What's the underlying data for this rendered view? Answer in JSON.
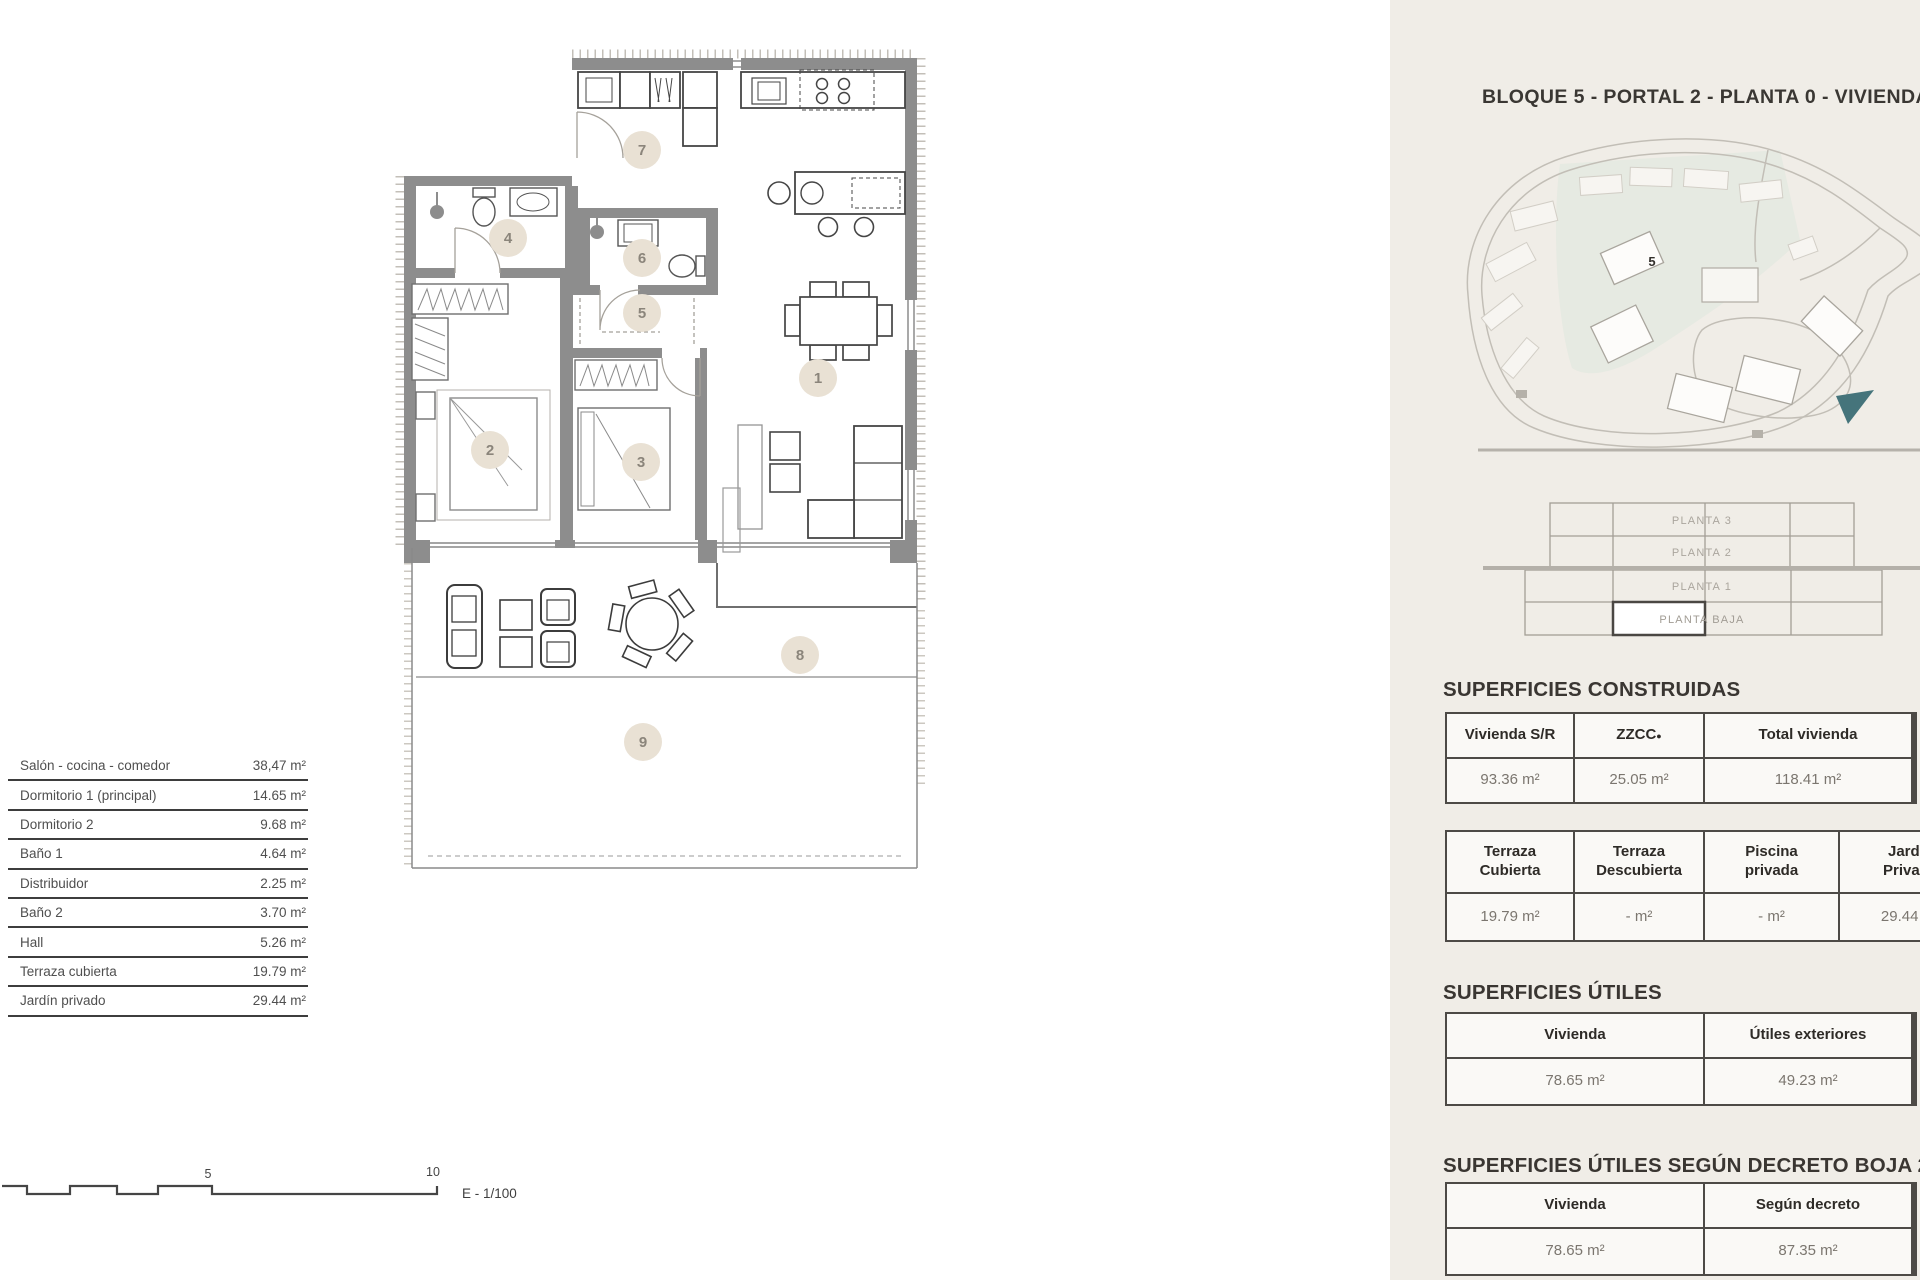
{
  "header": {
    "title": "BLOQUE 5 - PORTAL 2 - PLANTA 0 - VIVIENDA B"
  },
  "legend": {
    "rows": [
      {
        "name": "Salón - cocina - comedor",
        "area": "38,47 m²"
      },
      {
        "name": "Dormitorio 1 (principal)",
        "area": "14.65 m²"
      },
      {
        "name": "Dormitorio 2",
        "area": "9.68 m²"
      },
      {
        "name": "Baño 1",
        "area": "4.64 m²"
      },
      {
        "name": "Distribuidor",
        "area": "2.25 m²"
      },
      {
        "name": "Baño 2",
        "area": "3.70 m²"
      },
      {
        "name": "Hall",
        "area": "5.26 m²"
      },
      {
        "name": "Terraza cubierta",
        "area": "19.79 m²"
      },
      {
        "name": "Jardín privado",
        "area": "29.44 m²"
      }
    ]
  },
  "plan": {
    "markers": [
      "1",
      "2",
      "3",
      "4",
      "5",
      "6",
      "7",
      "8",
      "9"
    ]
  },
  "scale_bar": {
    "mid": "5",
    "end": "10",
    "ratio": "E - 1/100"
  },
  "site_map": {
    "building_label": "5"
  },
  "floor_stack": {
    "floors": [
      "PLANTA 3",
      "PLANTA 2",
      "PLANTA 1",
      "PLANTA BAJA"
    ],
    "highlighted": "PLANTA BAJA"
  },
  "sections": {
    "construidas": {
      "heading": "SUPERFICIES CONSTRUIDAS",
      "table1": {
        "headers": [
          "Vivienda S/R",
          "ZZCC",
          "Total vivienda"
        ],
        "sup": "●",
        "values": [
          "93.36 m²",
          "25.05 m²",
          "118.41 m²"
        ]
      },
      "table2": {
        "headers": [
          [
            "Terraza",
            "Cubierta"
          ],
          [
            "Terraza",
            "Descubierta"
          ],
          [
            "Piscina",
            "privada"
          ],
          [
            "Jardín",
            "Privado"
          ]
        ],
        "values": [
          "19.79 m²",
          "- m²",
          "- m²",
          "29.44 m²"
        ]
      }
    },
    "utiles": {
      "heading": "SUPERFICIES ÚTILES",
      "table": {
        "headers": [
          "Vivienda",
          "Útiles exteriores"
        ],
        "values": [
          "78.65 m²",
          "49.23 m²"
        ]
      }
    },
    "decreto": {
      "heading": "SUPERFICIES ÚTILES SEGÚN DECRETO BOJA 218/2",
      "table": {
        "headers": [
          "Vivienda",
          "Según decreto"
        ],
        "values": [
          "78.65 m²",
          "87.35 m²"
        ]
      }
    }
  },
  "colors": {
    "panel_bg": "#f0ede7",
    "wall_gray": "#8d8d8d",
    "marker_fill": "#e9e1d4",
    "marker_text": "#8b857b",
    "map_arrow_teal": "#45747b",
    "table_border": "#4d4a46"
  }
}
